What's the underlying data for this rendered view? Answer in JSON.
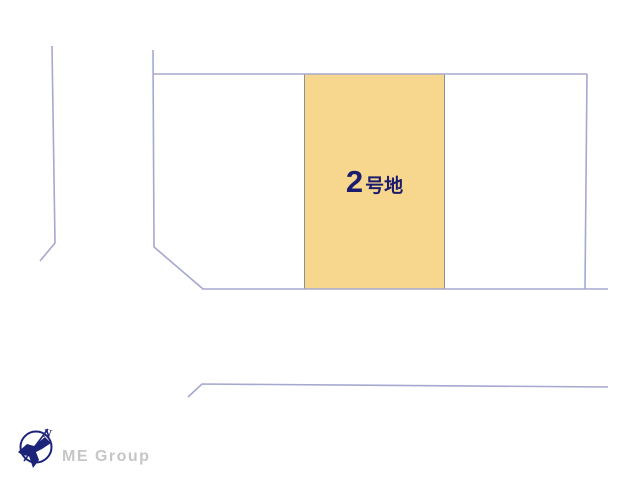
{
  "diagram": {
    "type": "land-plot-layout",
    "highlighted_plot": {
      "label": "2号地",
      "number": "2",
      "suffix": "号地",
      "fill": "#f7d68d",
      "border_color": "#8f8f9b",
      "label_color": "#1c1c6e"
    },
    "line_color": "#a5a8cf",
    "background_color": "#ffffff"
  },
  "logo": {
    "company": "ME Group",
    "compass_north_label": "N",
    "icon": "compass-bird-icon",
    "mark_color": "#1b2478",
    "text_color": "#c6c6c6"
  }
}
